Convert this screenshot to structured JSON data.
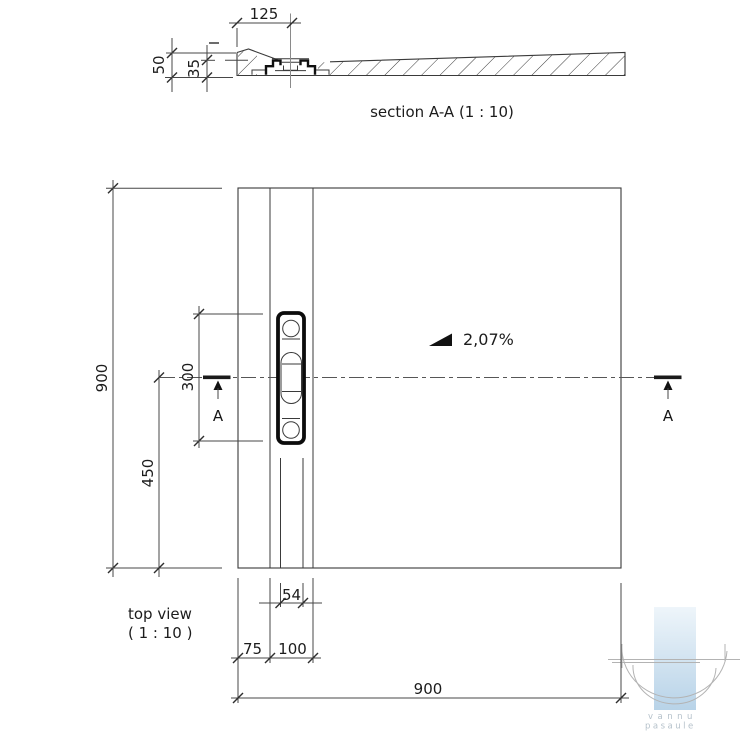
{
  "section_view": {
    "label": "section A-A (1 : 10)",
    "dims": {
      "offset_125": "125",
      "height_50": "50",
      "height_35": "35"
    }
  },
  "top_view": {
    "label_line1": "top view",
    "label_line2": "( 1 : 10 )",
    "slope_label": "2,07%",
    "section_marker_left": "A",
    "section_marker_right": "A",
    "dims": {
      "side_900": "900",
      "drain_length_300": "300",
      "offset_450": "450",
      "drain_width_54": "54",
      "offset_75": "75",
      "offset_100": "100",
      "bottom_width_900": "900"
    }
  },
  "watermark": {
    "word1": "vannu",
    "word2": "pasaule"
  },
  "colors": {
    "line": "#3a3a3a",
    "dimension": "#474747",
    "text": "#1c1c1c",
    "centerline": "#565656",
    "grate_stroke": "#0c0c0c",
    "watermark_blue_top": "#eaf2f8",
    "watermark_blue_bottom": "#b8d3e8",
    "watermark_gray": "#b3b3b3",
    "watermark_text": "#b6c2cb"
  }
}
